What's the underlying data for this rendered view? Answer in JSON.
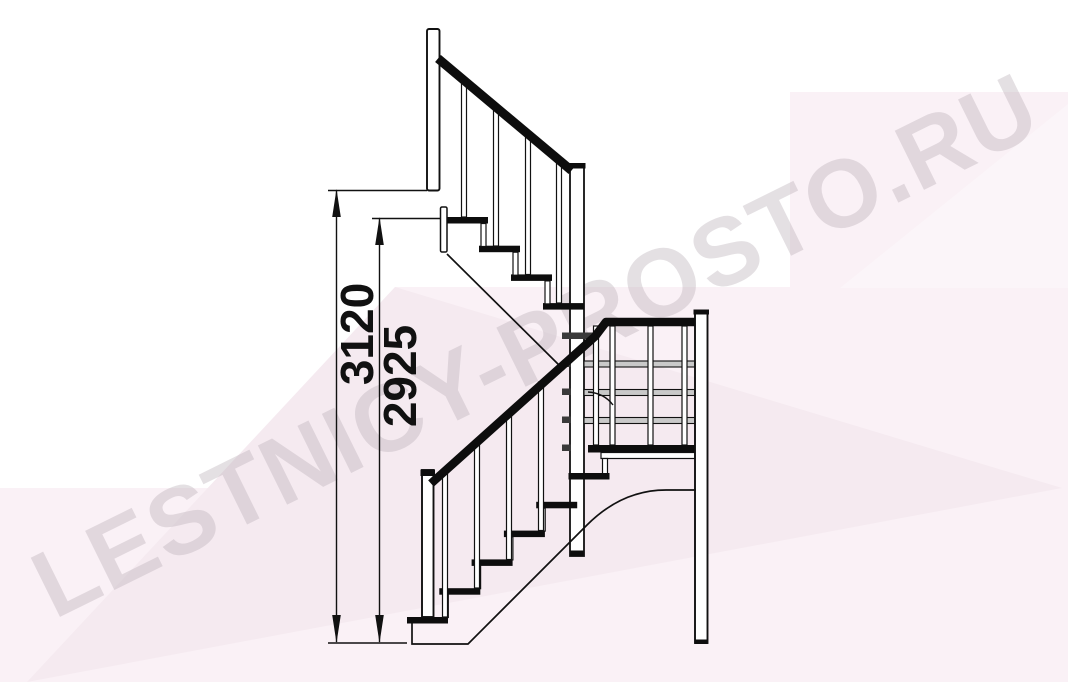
{
  "title": "Staircase side elevation technical drawing",
  "watermark": {
    "text": "LESTNICY-PROSTO.RU"
  },
  "dimensions": {
    "total_height": {
      "value": "3120",
      "meaning": "overall rise to upper floor level"
    },
    "height_to_top_tread": {
      "value": "2925",
      "meaning": "rise to last tread below floor"
    }
  },
  "colors": {
    "line": "#111111",
    "handrail": "#0d0d0d",
    "pink_light": "#faf1f6",
    "pink_dark": "#f5eaf0",
    "rail_gray": "#c9c9c9",
    "tab_gray": "#3a3a3a",
    "watermark_text": "rgba(184,174,181,0.38)"
  }
}
